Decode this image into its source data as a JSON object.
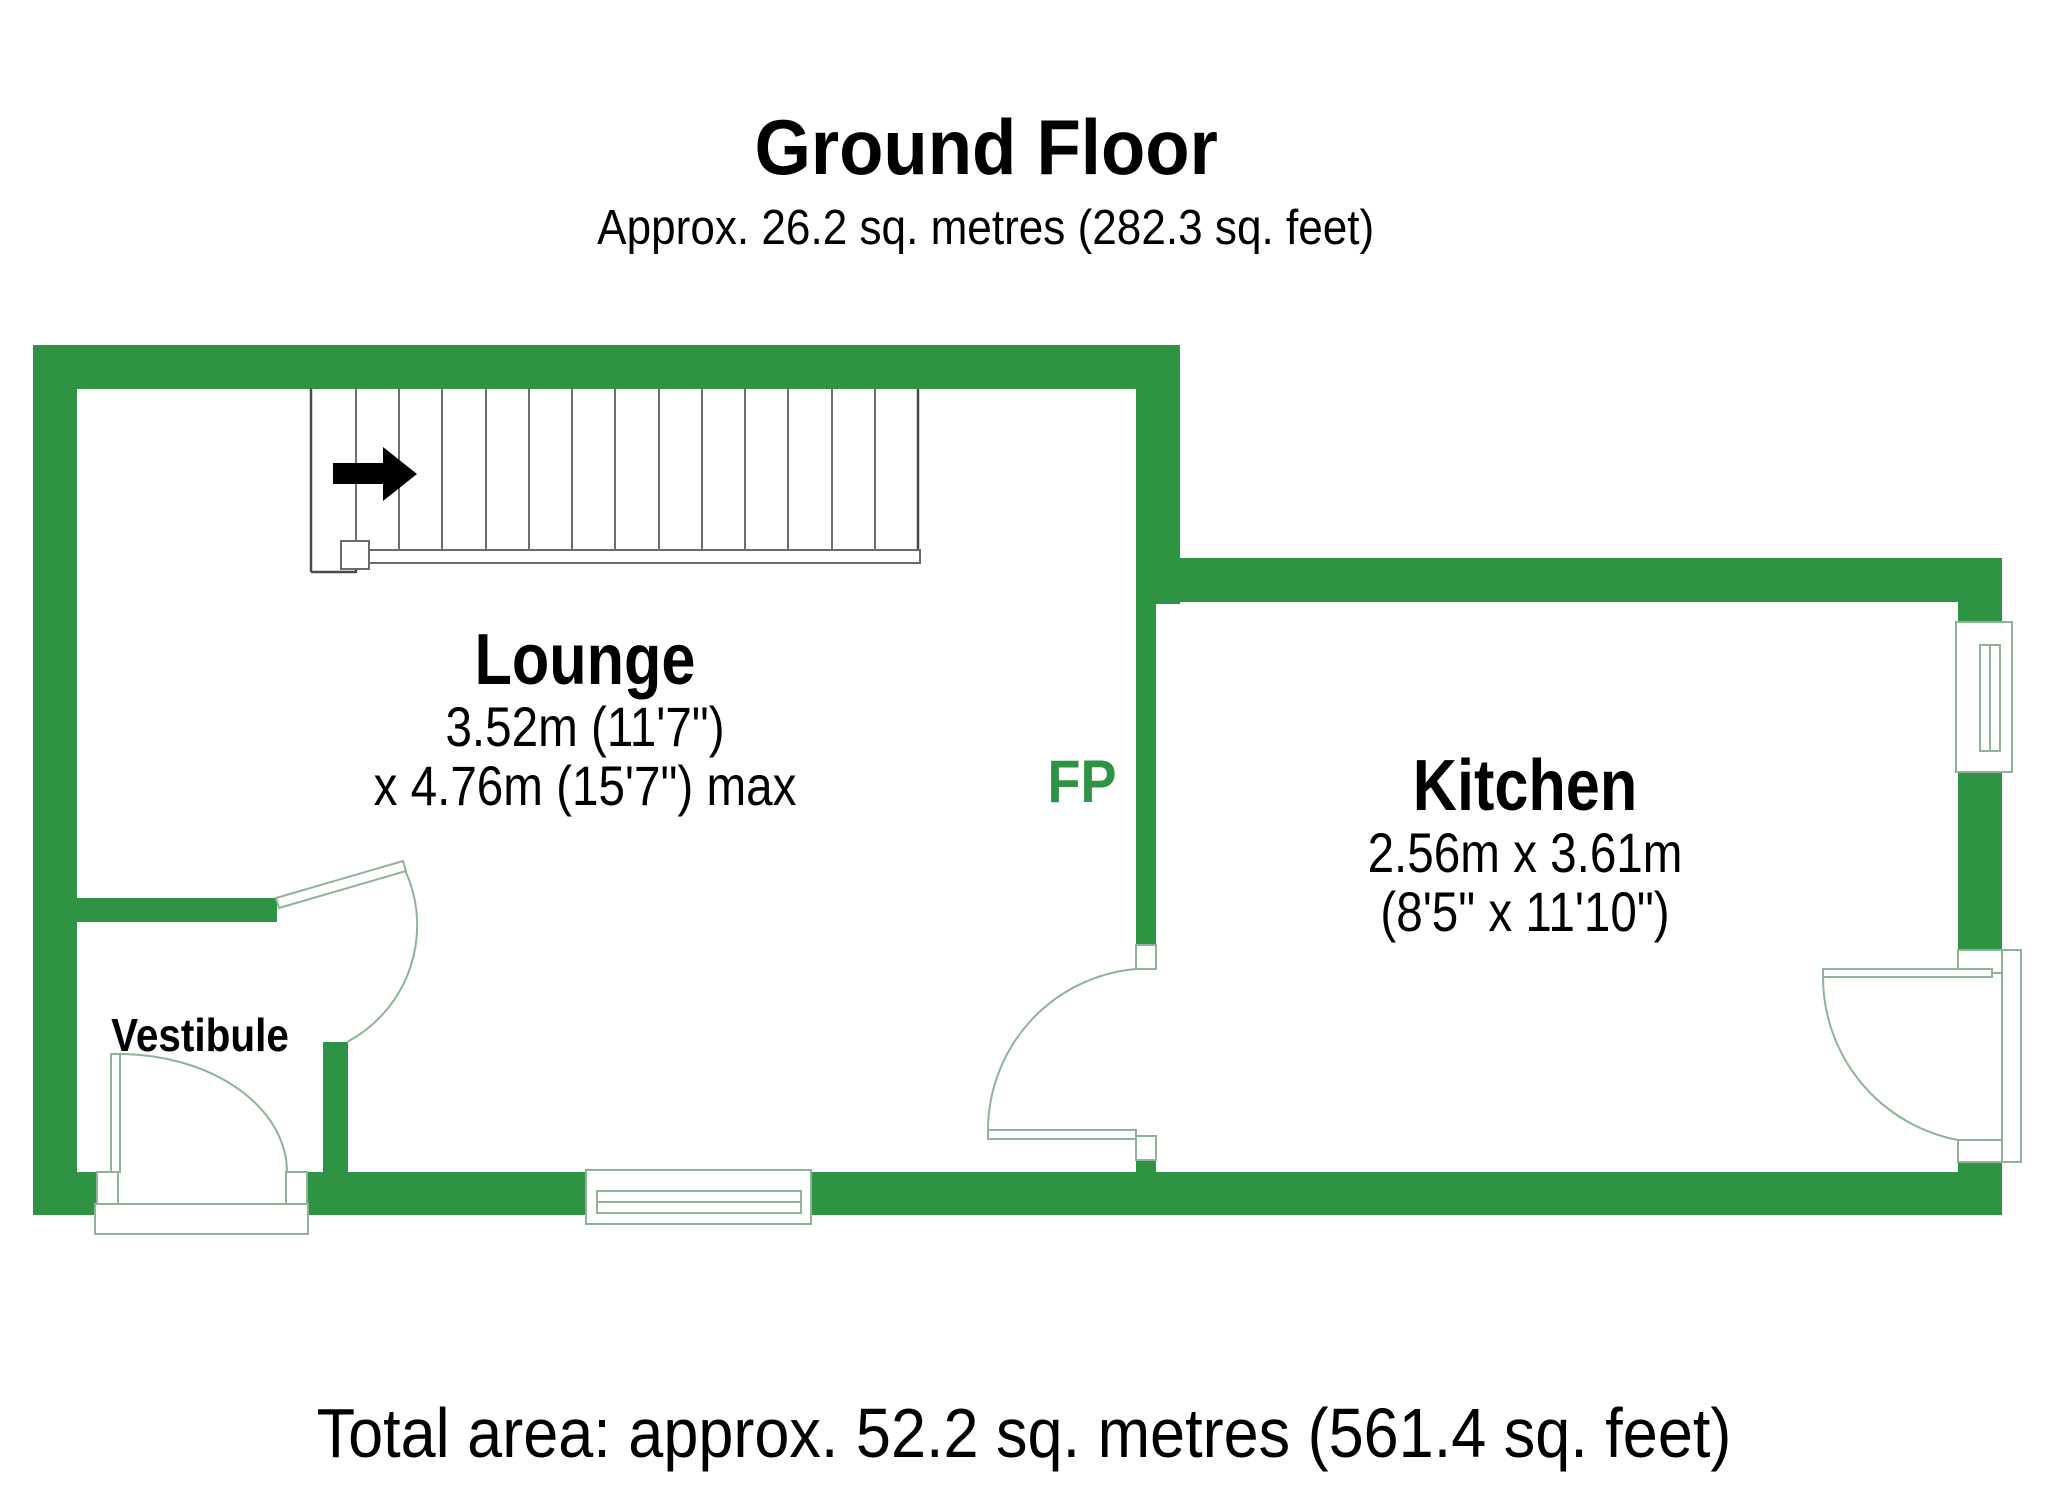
{
  "page": {
    "title": "Ground Floor",
    "subtitle": "Approx. 26.2 sq. metres (282.3 sq. feet)",
    "footer_total": "Total area: approx. 52.2 sq. metres (561.4 sq. feet)"
  },
  "rooms": {
    "lounge": {
      "name": "Lounge",
      "dim1": "3.52m (11'7\")",
      "dim2": "x 4.76m (15'7\") max"
    },
    "kitchen": {
      "name": "Kitchen",
      "dim1": "2.56m x 3.61m",
      "dim2": "(8'5\" x 11'10\")"
    },
    "vestibule": {
      "name": "Vestibule"
    }
  },
  "annotations": {
    "fireplace": "FP"
  },
  "colors": {
    "wall": "#2e9342",
    "fixture": "#8fb396",
    "stair": "#6e6e6e",
    "arrow": "#000000",
    "text": "#000000",
    "fp_text": "#2e9342"
  }
}
